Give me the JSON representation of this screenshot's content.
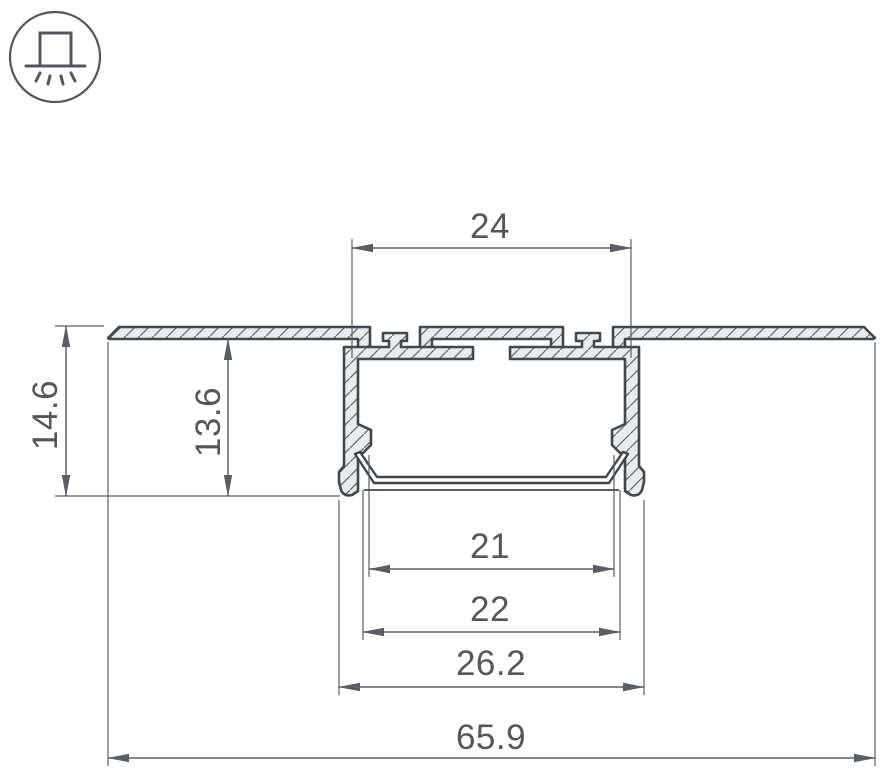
{
  "drawing": {
    "icon": {
      "name": "recessed-mount-icon",
      "meaning": "recessed ceiling mounting"
    },
    "dimensions": {
      "top_slot_width": "24",
      "overall_height": "14.6",
      "recess_depth": "13.6",
      "diffuser_width": "21",
      "opening_width": "22",
      "body_width": "26.2",
      "flange_width": "65.9"
    },
    "colors": {
      "background": "#ffffff",
      "profile_outline": "#42474c",
      "profile_fill": "#e9ebec",
      "hatch_line": "#666b70",
      "dimension_line": "#5a5e63",
      "dimension_text": "#53575c"
    }
  }
}
